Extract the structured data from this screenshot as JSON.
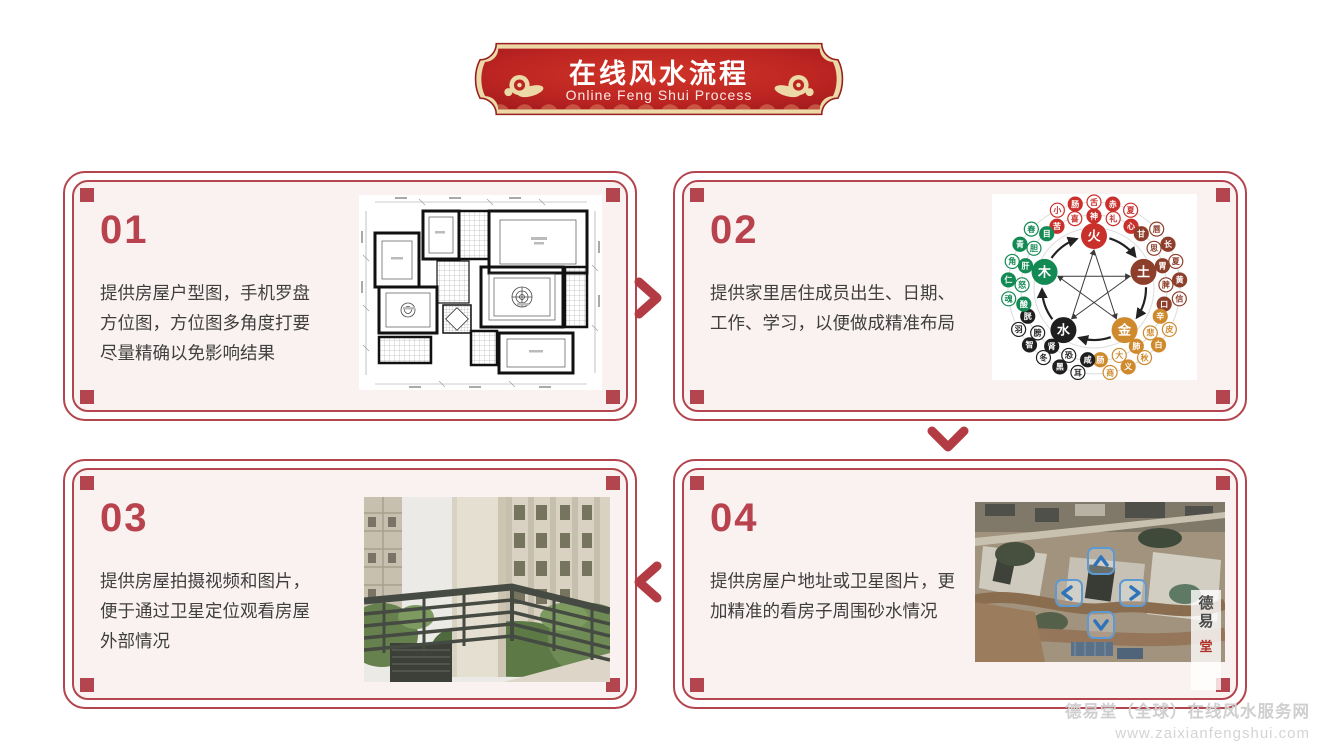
{
  "header": {
    "title": "在线风水流程",
    "subtitle": "Online Feng Shui Process"
  },
  "steps": [
    {
      "number": "01",
      "text": "提供房屋户型图，手机罗盘\n方位图，方位图多角度打要\n尽量精确以免影响结果",
      "image": "floor-plan"
    },
    {
      "number": "02",
      "text": "提供家里居住成员出生、日期、\n工作、学习，以便做成精准布局",
      "image": "five-elements-diagram"
    },
    {
      "number": "03",
      "text": "提供房屋拍摄视频和图片，\n便于通过卫星定位观看房屋\n外部情况",
      "image": "balcony-photo"
    },
    {
      "number": "04",
      "text": "提供房屋户地址或卫星图片，更\n加精准的看房子周围砂水情况",
      "image": "satellite-map"
    }
  ],
  "flow_arrows": [
    "right",
    "down",
    "left"
  ],
  "five_elements": {
    "elements": [
      {
        "name": "火",
        "color": "#c9302c",
        "satellites": [
          "苦",
          "喜",
          "神",
          "礼",
          "心",
          "小",
          "肠",
          "舌",
          "赤",
          "夏"
        ]
      },
      {
        "name": "土",
        "color": "#8d3f2b",
        "satellites": [
          "甘",
          "思",
          "胃",
          "脾",
          "口",
          "唇",
          "长",
          "夏",
          "黄",
          "信"
        ]
      },
      {
        "name": "金",
        "color": "#cf8a2d",
        "satellites": [
          "辛",
          "悲",
          "肺",
          "大",
          "肠",
          "皮",
          "白",
          "秋",
          "义",
          "商"
        ]
      },
      {
        "name": "水",
        "color": "#1f1f1f",
        "satellites": [
          "咸",
          "恐",
          "肾",
          "膀",
          "胱",
          "耳",
          "黑",
          "冬",
          "智",
          "羽"
        ]
      },
      {
        "name": "木",
        "color": "#138a53",
        "satellites": [
          "酸",
          "怒",
          "肝",
          "胆",
          "目",
          "魂",
          "仁",
          "角",
          "青",
          "春"
        ]
      }
    ]
  },
  "map_stamp": {
    "chars": [
      "德",
      "易",
      "堂"
    ]
  },
  "watermark": {
    "line1": "德易堂（全球）在线风水服务网",
    "line2": "www.zaixianfengshui.com"
  },
  "colors": {
    "accent_red": "#b2454e",
    "number_red": "#b8434e",
    "card_background": "#faf2f0",
    "banner_red": "#c32823",
    "banner_red_dark": "#a01a1d",
    "banner_gold": "#ecd9a8",
    "text_dark": "#3f3f3f",
    "watermark_gray": "#cfcfcf",
    "nav_arrow_blue": "#2f74ba"
  }
}
